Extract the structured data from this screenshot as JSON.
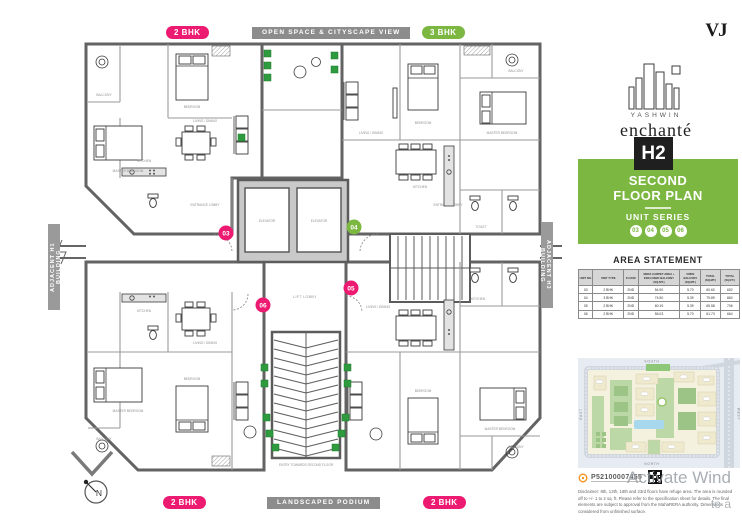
{
  "colors": {
    "pink": "#EC1A70",
    "green": "#7CB742",
    "gray_badge": "#8C8C8C",
    "dark": "#1F1F1F"
  },
  "brand": {
    "vj_logo": "VJ",
    "name_small": "YASHWIN",
    "name_large": "enchanté"
  },
  "header": {
    "tower_badge": "H2",
    "floor_title_line1": "SECOND",
    "floor_title_line2": "FLOOR PLAN",
    "unit_series_label": "UNIT SERIES",
    "unit_series": [
      "03",
      "04",
      "05",
      "06"
    ]
  },
  "plan": {
    "badges": {
      "top_unit_left": "2 BHK",
      "top_center": "OPEN SPACE & CITYSCAPE VIEW",
      "top_unit_right": "3 BHK",
      "bottom_unit_left": "2 BHK",
      "bottom_center": "LANDSCAPED PODIUM",
      "bottom_unit_right": "2 BHK",
      "side_left": "ADJACENT H1 BUILDING",
      "side_right": "ADJACENT H3 BUILDING"
    },
    "units": [
      {
        "number": "03",
        "type": "2 BHK"
      },
      {
        "number": "04",
        "type": "3 BHK"
      },
      {
        "number": "05",
        "type": "2 BHK"
      },
      {
        "number": "06",
        "type": "2 BHK"
      }
    ],
    "labels": {
      "elevator": "ELEVATOR",
      "lift_lobby": "LIFT LOBBY",
      "entrance_lobby": "ENTRANCE LOBBY",
      "master_bedroom": "MASTER BEDROOM",
      "bedroom": "BEDROOM",
      "kitchen": "KITCHEN",
      "living_dining": "LIVING / DINING",
      "balcony": "BALCONY",
      "toilet": "TOILET",
      "entry_stair": "ENTRY TOWARDS SECOND FLOOR",
      "compass_n": "N"
    }
  },
  "area_statement": {
    "title": "AREA STATEMENT",
    "headers": [
      "UNIT NO.",
      "UNIT TYPE",
      "FLOOR",
      "RERA CARPET AREA + ENCLOSED BALCONY (SQ.MT.)",
      "OPEN BALCONY (SQ.MT.)",
      "TOTAL (SQ.MT.)",
      "TOTAL (SQ.FT.)"
    ],
    "rows": [
      [
        "03",
        "2 BHK",
        "2ND",
        "54.90",
        "5.70",
        "60.60",
        "652"
      ],
      [
        "04",
        "3 BHK",
        "2ND",
        "74.50",
        "5.39",
        "79.89",
        "860"
      ],
      [
        "05",
        "2 BHK",
        "2ND",
        "60.19",
        "5.39",
        "65.58",
        "706"
      ],
      [
        "06",
        "2 BHK",
        "2ND",
        "56.03",
        "5.70",
        "61.73",
        "664"
      ]
    ]
  },
  "map": {
    "compass": {
      "top": "SOUTH",
      "bottom": "NORTH",
      "left": "EAST",
      "right": "WEST"
    }
  },
  "footer": {
    "rera_no": "P52100007455",
    "disclaimer": "Disclaimer: 8th, 13th, 18th and 23rd floors have refuge area. The area is rounded off to +/- 1 to 2 sq. ft. Please refer to the specification sheet for details. The final elements are subject to approval from the MahaRERA authority. Dimensions considered from unfinished surface."
  },
  "watermark": {
    "line1": "Activate Wind",
    "line2": "to a"
  }
}
